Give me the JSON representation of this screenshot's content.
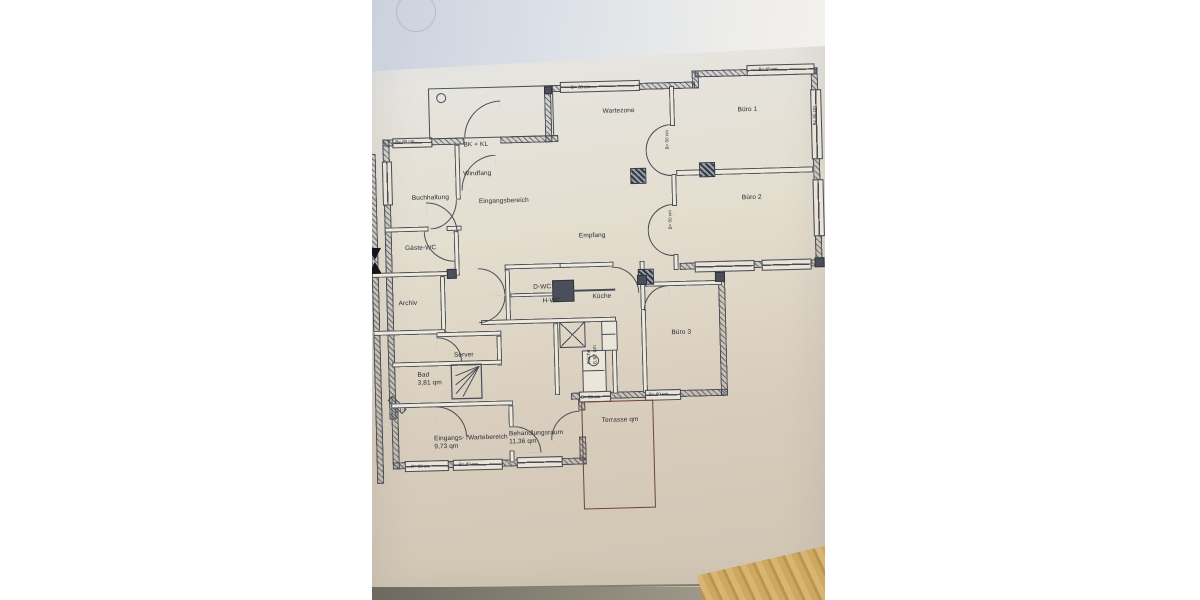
{
  "scene": {
    "description": "Photograph of a paper architectural floor plan lying on a wooden table",
    "paper_color": "#ddd4c3",
    "background_color": "#ffffff",
    "wood_color": "#cda85f",
    "ink_color": "#474c57"
  },
  "plan": {
    "rooms": [
      {
        "id": "bkkl",
        "name": "BK + KL"
      },
      {
        "id": "windfang",
        "name": "Windfang"
      },
      {
        "id": "buchhaltung",
        "name": "Buchhaltung"
      },
      {
        "id": "eingangsbereich",
        "name": "Eingangsbereich"
      },
      {
        "id": "gaeste_wc",
        "name": "Gäste-WC"
      },
      {
        "id": "archiv",
        "name": "Archiv"
      },
      {
        "id": "server",
        "name": "Server"
      },
      {
        "id": "bad",
        "name": "Bad",
        "area": "3,81 qm"
      },
      {
        "id": "eingangs_wartebereich",
        "name": "Eingangs- /Wartebereich",
        "area": "9,73 qm"
      },
      {
        "id": "behandlungsraum",
        "name": "Behandlungsraum",
        "area": "11,36 qm"
      },
      {
        "id": "d_wc",
        "name": "D-WC"
      },
      {
        "id": "h_wc",
        "name": "H-WC"
      },
      {
        "id": "kueche",
        "name": "Küche"
      },
      {
        "id": "kueche_klein",
        "name": "Küche",
        "area": "6,62 qm"
      },
      {
        "id": "empfang",
        "name": "Empfang"
      },
      {
        "id": "wartezone",
        "name": "Wartezone"
      },
      {
        "id": "buero1",
        "name": "Büro 1"
      },
      {
        "id": "buero2",
        "name": "Büro 2"
      },
      {
        "id": "buero3",
        "name": "Büro 3"
      },
      {
        "id": "terrasse",
        "name": "Terrasse qm"
      }
    ],
    "dimension_labels": {
      "window_80": "B= 80 cm",
      "door_50": "B= 50 cm"
    },
    "logo": {
      "letter": "N",
      "green": "#17695a",
      "red": "#a01b24"
    }
  }
}
